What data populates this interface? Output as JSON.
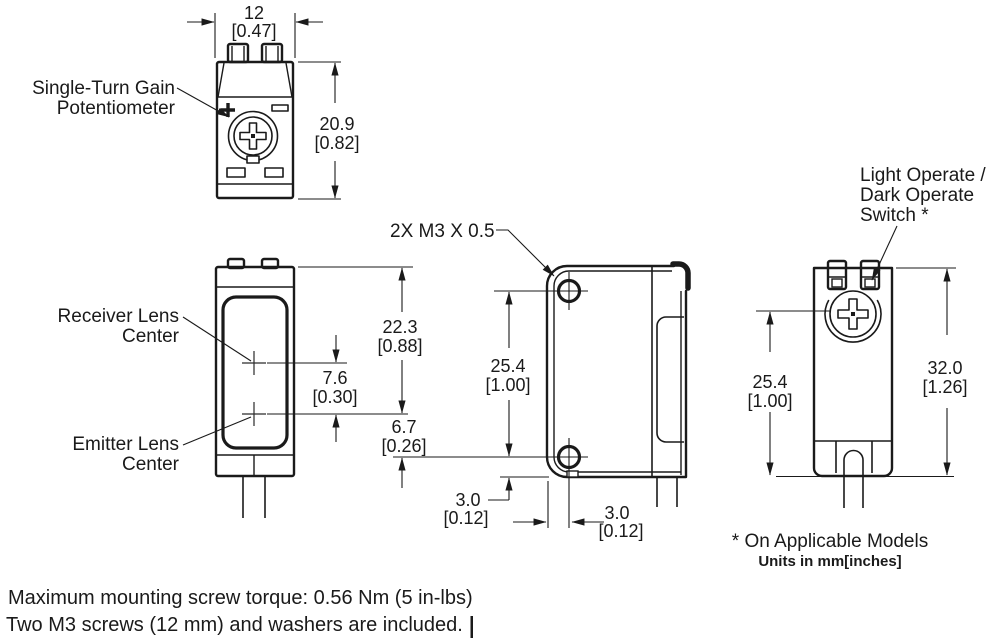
{
  "views": {
    "top": {
      "label_line1": "Single-Turn Gain",
      "label_line2": "Potentiometer",
      "width_mm": "12",
      "width_in": "[0.47]",
      "height_mm": "20.9",
      "height_in": "[0.82]"
    },
    "front": {
      "receiver_line1": "Receiver Lens",
      "receiver_line2": "Center",
      "emitter_line1": "Emitter Lens",
      "emitter_line2": "Center",
      "lens_gap_mm": "7.6",
      "lens_gap_in": "[0.30]",
      "top_to_emitter_mm": "22.3",
      "top_to_emitter_in": "[0.88]",
      "emitter_offset_mm": "6.7",
      "emitter_offset_in": "[0.26]"
    },
    "side": {
      "thread_callout": "2X M3 X 0.5",
      "hole_spacing_mm": "25.4",
      "hole_spacing_in": "[1.00]",
      "hole_to_bottom_mm": "3.0",
      "hole_to_bottom_in": "[0.12]",
      "hole_to_front_mm": "3.0",
      "hole_to_front_in": "[0.12]"
    },
    "rear": {
      "switch_label_line1": "Light Operate /",
      "switch_label_line2": "Dark Operate",
      "switch_label_line3": "Switch *",
      "switch_to_bottom_mm": "25.4",
      "switch_to_bottom_in": "[1.00]",
      "height_mm": "32.0",
      "height_in": "[1.26]"
    }
  },
  "footnotes": {
    "applicable_models": "* On Applicable Models",
    "units": "Units in mm[inches]"
  },
  "notes": {
    "torque": "Maximum mounting screw torque: 0.56 Nm (5 in-lbs)",
    "included": "Two M3 screws (12 mm) and washers are included."
  }
}
